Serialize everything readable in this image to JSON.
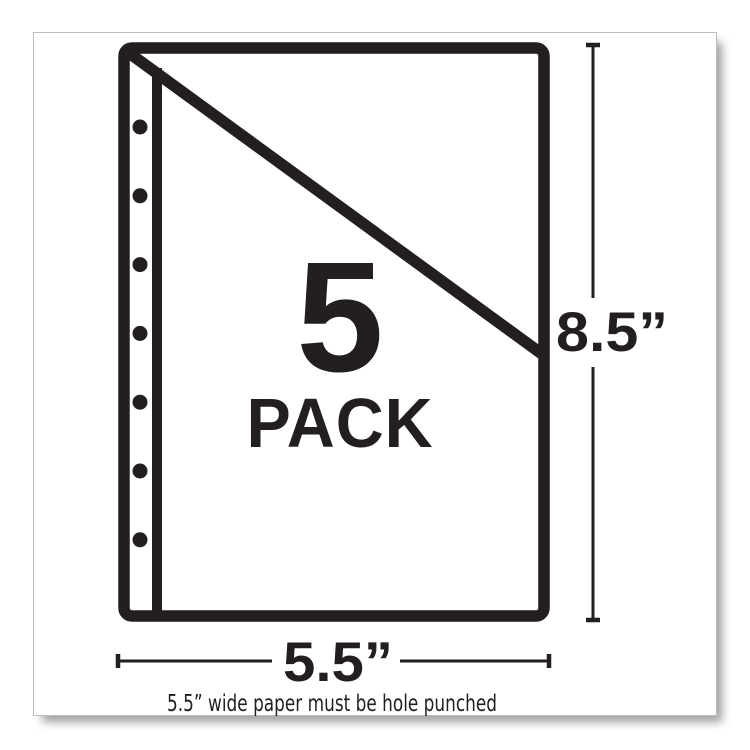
{
  "image": {
    "background_color": "#ffffff",
    "frame_border_color": "#bcbcbc",
    "ink_color": "#231f20"
  },
  "pack": {
    "quantity": "5",
    "label": "PACK"
  },
  "dimensions": {
    "height_label": "8.5”",
    "width_label": "5.5”"
  },
  "diagram": {
    "sheet_icon": "sheet-protector-outline",
    "flap_icon": "diagonal-pocket-flap",
    "binding_icon": "binding-edge-line",
    "holes": {
      "count": 7,
      "icon": "punch-hole-dot"
    }
  },
  "footnote": {
    "text": "5.5” wide paper must be hole punched"
  }
}
